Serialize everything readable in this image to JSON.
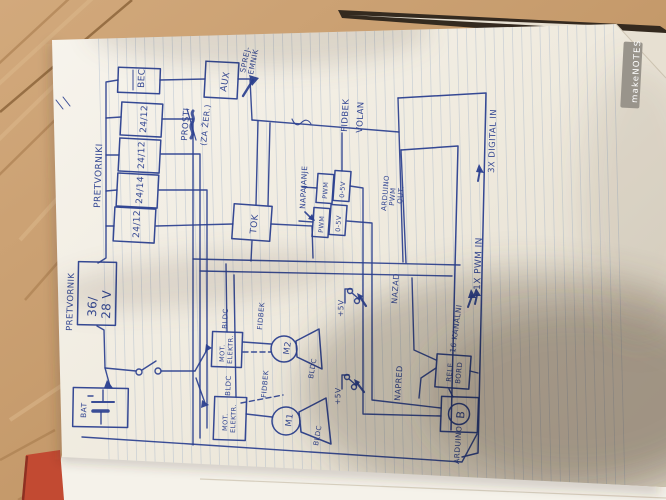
{
  "colors": {
    "ink": "#2a3f8f",
    "paper": "#f4f0e8",
    "wood": "#c59a6b",
    "spine_red": "#c24a32",
    "rule_line": "#93a7c4",
    "watermark_bg": "#99948b",
    "watermark_text": "#ffffff"
  },
  "watermark": {
    "brand": "makeNOTES"
  },
  "schematic": {
    "converter_group": {
      "label": "PRETVORNIKI",
      "boxes": [
        "BEC",
        "24/12",
        "24/12",
        "24/14",
        "24/12"
      ]
    },
    "note": {
      "line1": "PROSTI",
      "line2": "(ZA ŽER.)"
    },
    "receiver": {
      "box": "AUX",
      "label_line1": "SPREJ-",
      "label_line2": "EMNIK"
    },
    "steering": {
      "line1": "FIDBEK",
      "line2": "VOLAN"
    },
    "arduino_inputs": {
      "digital": "3X DIGITAL IN",
      "pwm": "1X PWM IN"
    },
    "main_converter": {
      "label": "PRETVORNIK",
      "value_line1": "36/",
      "value_line2": "28 V"
    },
    "battery": {
      "label": "BAT"
    },
    "current_sensor": {
      "label": "TOK"
    },
    "power_label": "NAPAJANJE",
    "pwm_modules": {
      "input": "PWM",
      "output": "0-5V"
    },
    "arduino_pwm_out": {
      "line1": "ARDUINO",
      "line2": "PWM",
      "line3": "OUT."
    },
    "esc": {
      "line1": "MOT.",
      "line2": "ELEKTR."
    },
    "motor_type": "BLDC",
    "feedback": "FIDBEK",
    "motors": {
      "m1": "M1",
      "m2": "M2"
    },
    "controls": {
      "supply": "+5V",
      "back": "NAZAD",
      "forward": "NAPRED"
    },
    "relay": {
      "channels": "16 KANALNI",
      "line1": "RELE",
      "line2": "BORD"
    },
    "arduino": {
      "label": "ARDUINO",
      "logo": "B"
    }
  }
}
